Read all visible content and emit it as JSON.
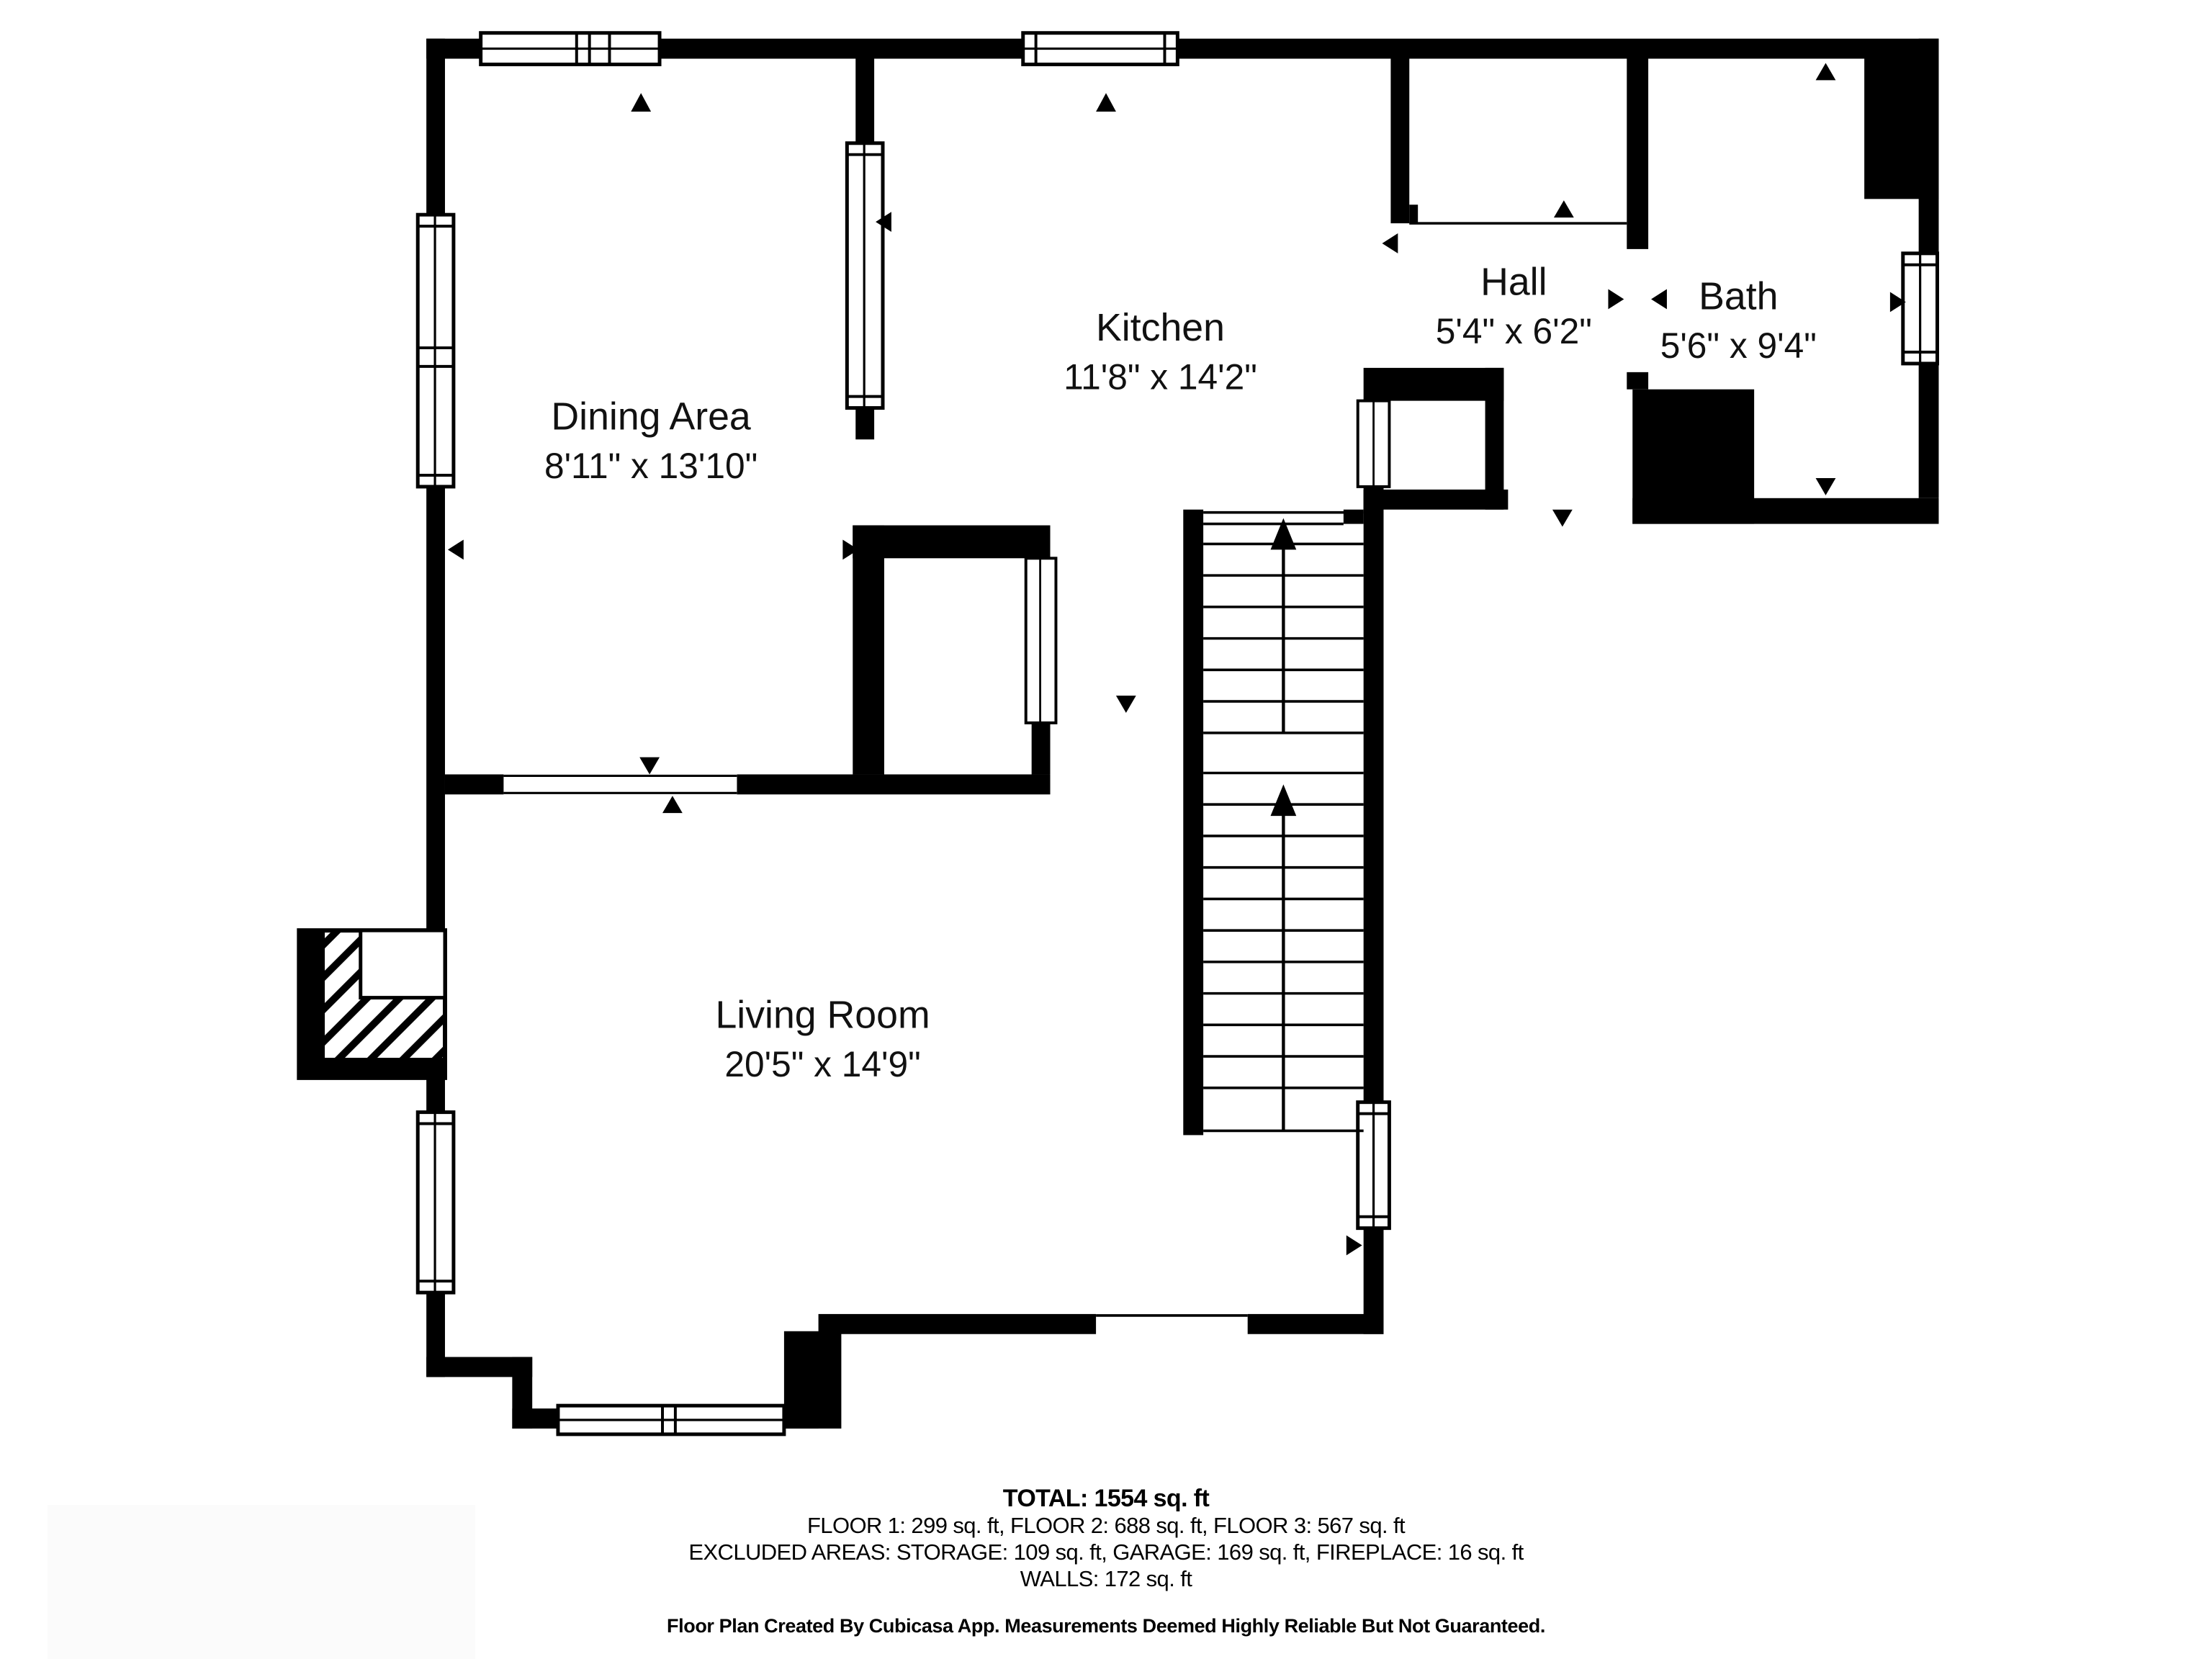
{
  "rooms": [
    {
      "name": "Dining Area",
      "dims": "8'11\" x 13'10\""
    },
    {
      "name": "Kitchen",
      "dims": "11'8\" x 14'2\""
    },
    {
      "name": "Hall",
      "dims": "5'4\" x 6'2\""
    },
    {
      "name": "Bath",
      "dims": "5'6\" x 9'4\""
    },
    {
      "name": "Living Room",
      "dims": "20'5\" x 14'9\""
    }
  ],
  "summary": {
    "total": "TOTAL: 1554 sq. ft",
    "floors": "FLOOR 1: 299 sq. ft, FLOOR 2: 688 sq. ft, FLOOR 3: 567 sq. ft",
    "excluded": "EXCLUDED AREAS: STORAGE: 109 sq. ft, GARAGE: 169 sq. ft, FIREPLACE: 16 sq. ft",
    "walls": "WALLS: 172 sq. ft"
  },
  "footer": "Floor Plan Created By Cubicasa App. Measurements Deemed Highly Reliable But Not Guaranteed.",
  "colors": {
    "wall": "#000000",
    "background": "#ffffff",
    "text": "#111111"
  },
  "icons": [
    "door-arrow-icon",
    "stairs-up-arrow-icon",
    "window-icon",
    "fireplace-hatch-icon"
  ]
}
